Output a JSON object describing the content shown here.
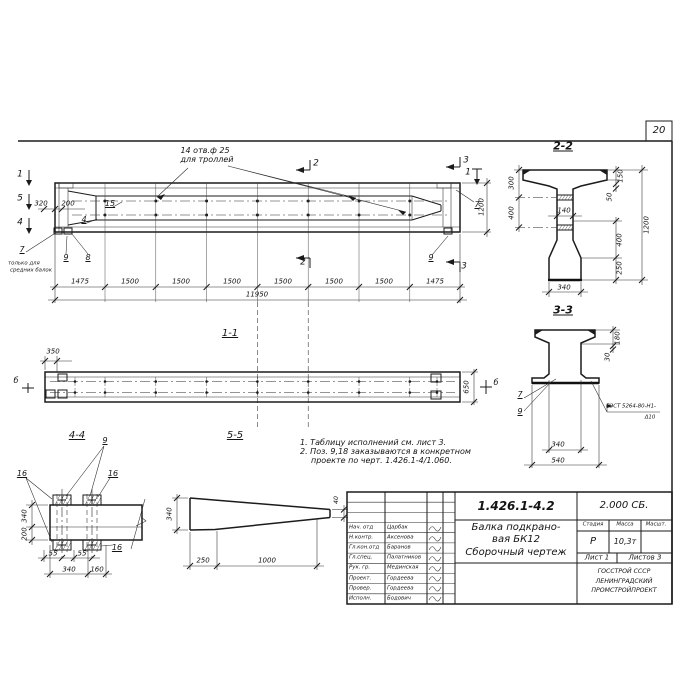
{
  "colors": {
    "ink": "#1b1b1b",
    "paper": "#ffffff"
  },
  "sheet": {
    "number": "20"
  },
  "main": {
    "hole_note_1": "14 отв.ф 25",
    "hole_note_2": "для троллей",
    "marks": {
      "m1": "1",
      "m2": "2",
      "m3": "3",
      "m4": "4",
      "m5": "5"
    },
    "positions": {
      "p4": "4",
      "p7": "7",
      "p8": "8",
      "p9": "9",
      "p15": "15"
    },
    "pos7_note_1": "только для",
    "pos7_note_2": "средних балок",
    "dims": {
      "d320": "320",
      "d200": "200",
      "d1200": "1200",
      "total": "11950",
      "segments": [
        "1475",
        "1500",
        "1500",
        "1500",
        "1500",
        "1500",
        "1500",
        "1475"
      ]
    }
  },
  "view11": {
    "label": "1-1",
    "d350": "350",
    "d650": "650",
    "mark_b": "б"
  },
  "view44": {
    "label": "4-4",
    "p9": "9",
    "p16": "16",
    "d340": "340",
    "d200": "200",
    "d55": "55",
    "db340": "340",
    "d160": "160"
  },
  "view55": {
    "label": "5-5",
    "d340": "340",
    "d40": "40",
    "d250": "250",
    "d1000": "1000"
  },
  "notes": {
    "line1": "1. Таблицу исполнений см. лист 3.",
    "line2": "2. Поз. 9,18 заказываются в конкретном",
    "line3": "проекте по черт. 1.426.1-4/1.060."
  },
  "sec22": {
    "label": "2-2",
    "d300": "300",
    "d400l": "400",
    "d140": "140",
    "d150": "150",
    "d50": "50",
    "d400r": "400",
    "d250": "250",
    "d1200": "1200",
    "d340": "340"
  },
  "sec33": {
    "label": "3-3",
    "d180": "180",
    "d30": "30",
    "d340": "340",
    "d540": "540",
    "p7": "7",
    "p9": "9",
    "weld_1": "ГОСТ 5264-80-Н1-",
    "weld_2": "Δ10"
  },
  "title_block": {
    "doc_number": "1.426.1-4.2",
    "code": "2.000 СБ.",
    "title_1": "Балка подкрано-",
    "title_2": "вая БК12",
    "title_3": "Сборочный чертеж",
    "h_stage": "Стадия",
    "h_mass": "Масса",
    "h_scale": "Масшт.",
    "stage": "Р",
    "mass": "10,3т",
    "sheet": "Лист 1",
    "sheets": "Листов 3",
    "org_1": "ГОССТРОЙ СССР",
    "org_2": "ЛЕНИНГРАДСКИЙ",
    "org_3": "ПРОМСТРОЙПРОЕКТ",
    "rows": [
      {
        "role": "Нач. отд",
        "name": "Царбак"
      },
      {
        "role": "Н.контр.",
        "name": "Аксенова"
      },
      {
        "role": "Гл.кон.отд",
        "name": "Баранов"
      },
      {
        "role": "Гл.спец.",
        "name": "Палатников"
      },
      {
        "role": "Рук. гр.",
        "name": "Мединская"
      },
      {
        "role": "Проект.",
        "name": "Гордеева"
      },
      {
        "role": "Провер.",
        "name": "Гордеева"
      },
      {
        "role": "Исполн.",
        "name": "Бодович"
      }
    ]
  }
}
